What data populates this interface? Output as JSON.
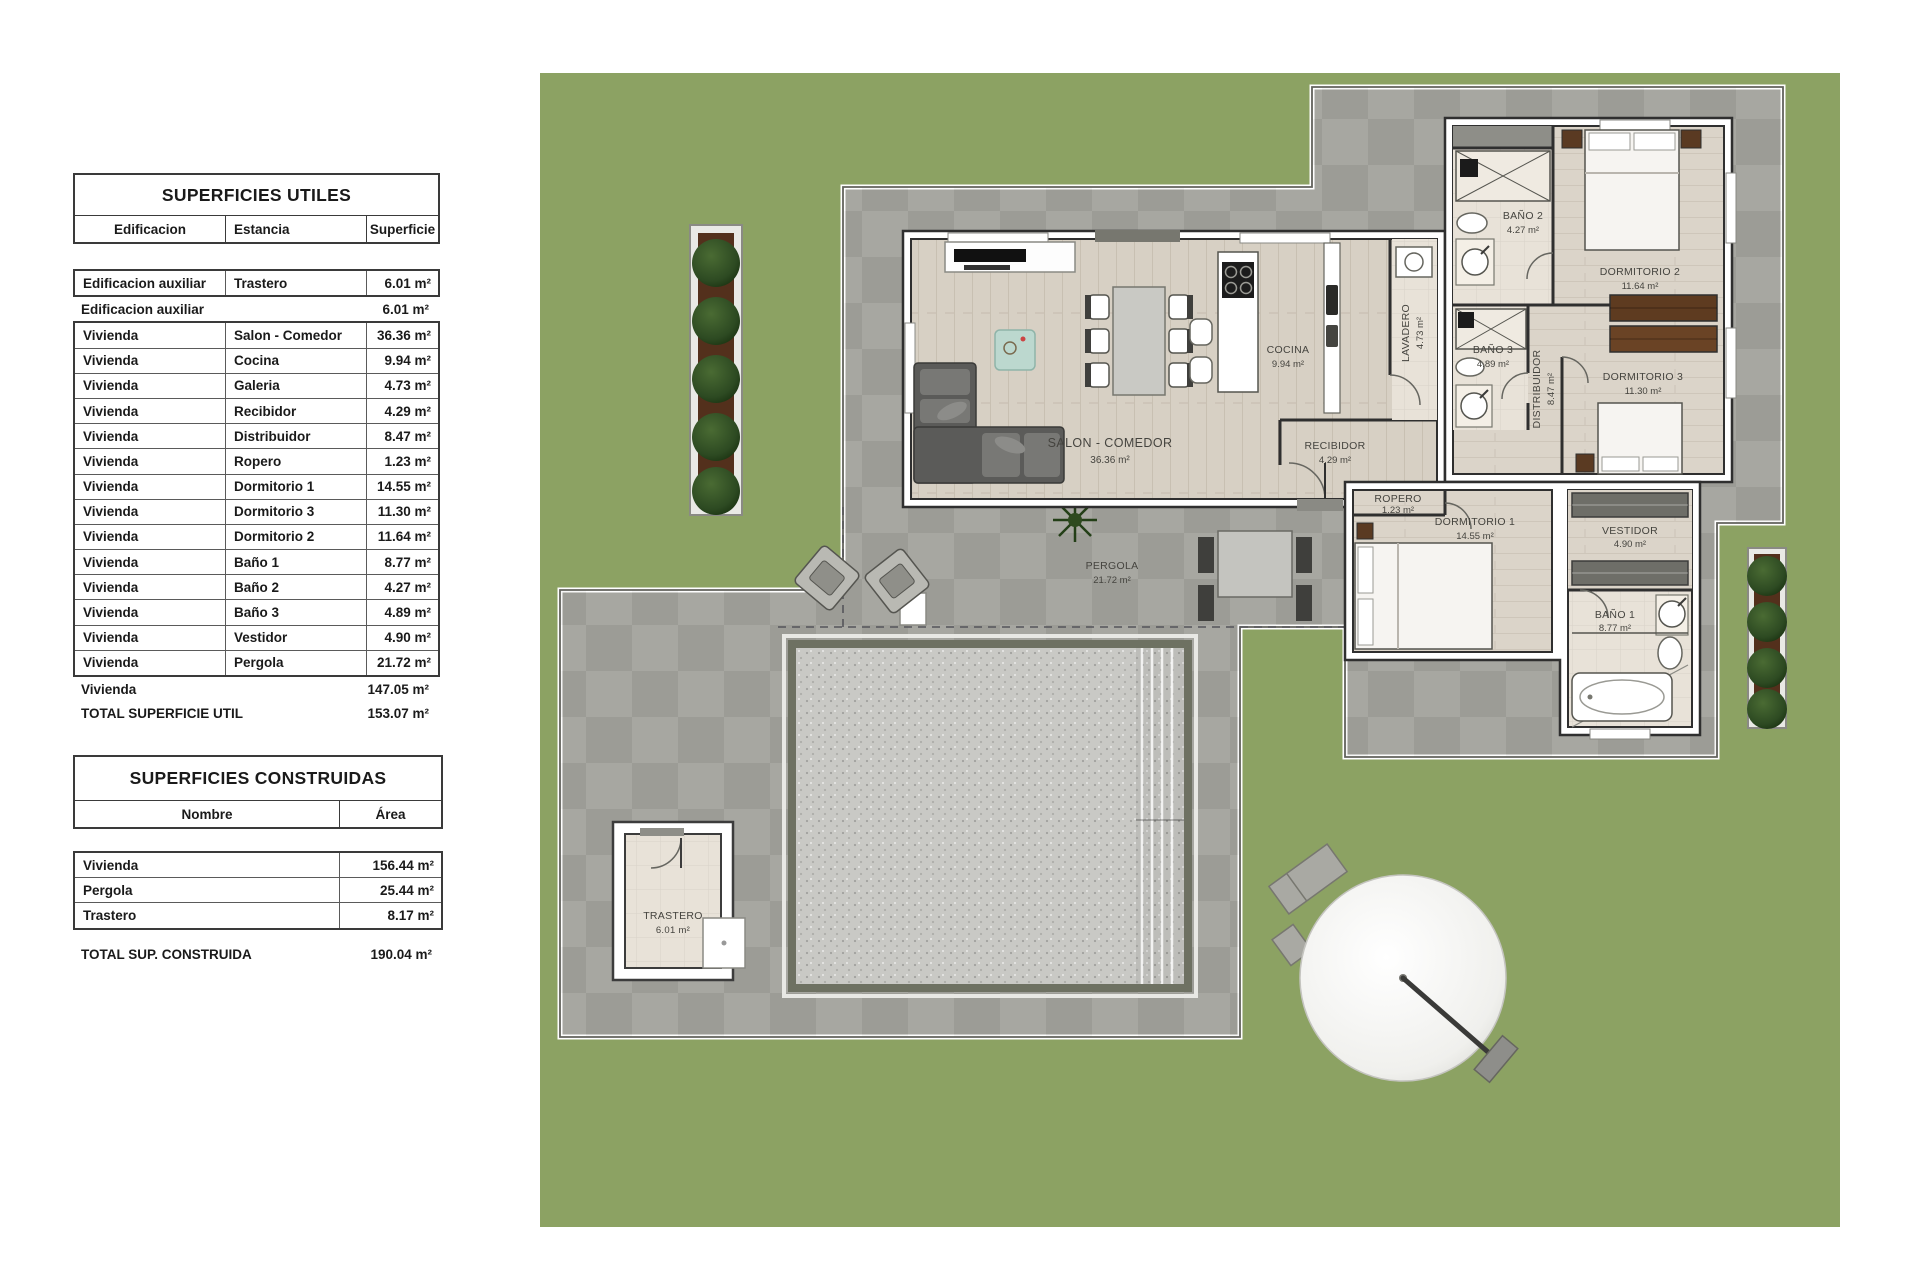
{
  "tables": {
    "utiles": {
      "title": "SUPERFICIES UTILES",
      "columns": [
        "Edificacion",
        "Estancia",
        "Superficie"
      ],
      "rows": [
        {
          "e": "Edificacion auxiliar",
          "s": "Trastero",
          "v": "6.01 m²"
        },
        {
          "e": "Edificacion auxiliar",
          "s": "",
          "v": "6.01 m²"
        },
        {
          "e": "Vivienda",
          "s": "Salon - Comedor",
          "v": "36.36 m²"
        },
        {
          "e": "Vivienda",
          "s": "Cocina",
          "v": "9.94 m²"
        },
        {
          "e": "Vivienda",
          "s": "Galeria",
          "v": "4.73 m²"
        },
        {
          "e": "Vivienda",
          "s": "Recibidor",
          "v": "4.29 m²"
        },
        {
          "e": "Vivienda",
          "s": "Distribuidor",
          "v": "8.47 m²"
        },
        {
          "e": "Vivienda",
          "s": "Ropero",
          "v": "1.23 m²"
        },
        {
          "e": "Vivienda",
          "s": "Dormitorio 1",
          "v": "14.55 m²"
        },
        {
          "e": "Vivienda",
          "s": "Dormitorio 3",
          "v": "11.30 m²"
        },
        {
          "e": "Vivienda",
          "s": "Dormitorio 2",
          "v": "11.64 m²"
        },
        {
          "e": "Vivienda",
          "s": "Baño 1",
          "v": "8.77 m²"
        },
        {
          "e": "Vivienda",
          "s": "Baño 2",
          "v": "4.27 m²"
        },
        {
          "e": "Vivienda",
          "s": "Baño 3",
          "v": "4.89 m²"
        },
        {
          "e": "Vivienda",
          "s": "Vestidor",
          "v": "4.90 m²"
        },
        {
          "e": "Vivienda",
          "s": "Pergola",
          "v": "21.72 m²"
        },
        {
          "e": "Vivienda",
          "s": "",
          "v": "147.05 m²"
        }
      ],
      "total_label": "TOTAL SUPERFICIE UTIL",
      "total_value": "153.07 m²"
    },
    "construidas": {
      "title": "SUPERFICIES CONSTRUIDAS",
      "columns": [
        "Nombre",
        "Área"
      ],
      "rows": [
        {
          "n": "Vivienda",
          "v": "156.44 m²"
        },
        {
          "n": "Pergola",
          "v": "25.44 m²"
        },
        {
          "n": "Trastero",
          "v": "8.17 m²"
        }
      ],
      "total_label": "TOTAL SUP. CONSTRUIDA",
      "total_value": "190.04 m²"
    }
  },
  "plan": {
    "labels": {
      "salon": {
        "name": "SALON - COMEDOR",
        "area": "36.36 m²"
      },
      "cocina": {
        "name": "COCINA",
        "area": "9.94 m²"
      },
      "lavadero": {
        "name": "LAVADERO",
        "area": "4.73 m²"
      },
      "recibidor": {
        "name": "RECIBIDOR",
        "area": "4.29 m²"
      },
      "ropero": {
        "name": "ROPERO",
        "area": "1.23 m²"
      },
      "distribuidor": {
        "name": "DISTRIBUIDOR",
        "area": "8.47 m²"
      },
      "bano2": {
        "name": "BAÑO 2",
        "area": "4.27 m²"
      },
      "dormitorio2": {
        "name": "DORMITORIO 2",
        "area": "11.64 m²"
      },
      "dormitorio3": {
        "name": "DORMITORIO 3",
        "area": "11.30 m²"
      },
      "bano3": {
        "name": "BAÑO 3",
        "area": "4.89 m²"
      },
      "dormitorio1": {
        "name": "DORMITORIO 1",
        "area": "14.55 m²"
      },
      "vestidor": {
        "name": "VESTIDOR",
        "area": "4.90 m²"
      },
      "bano1": {
        "name": "BAÑO 1",
        "area": "8.77 m²"
      },
      "pergola": {
        "name": "PERGOLA",
        "area": "21.72 m²"
      },
      "trastero": {
        "name": "TRASTERO",
        "area": "6.01 m²"
      }
    },
    "colors": {
      "grass": "#8ca263",
      "terrace": "#a1a19b",
      "wall": "#2f2f2f",
      "wood_floor": "#d7d0c4",
      "bedroom_floor": "#dbd4c9",
      "tile_floor": "#e8e2d8",
      "pool_rim": "#6e7162",
      "pool_water": "#c9c9c5",
      "tree": "#2d4a22",
      "planter_soil": "#53301c",
      "wardrobe_wood": "#5e3b20",
      "sofa": "#5b5b59"
    }
  }
}
